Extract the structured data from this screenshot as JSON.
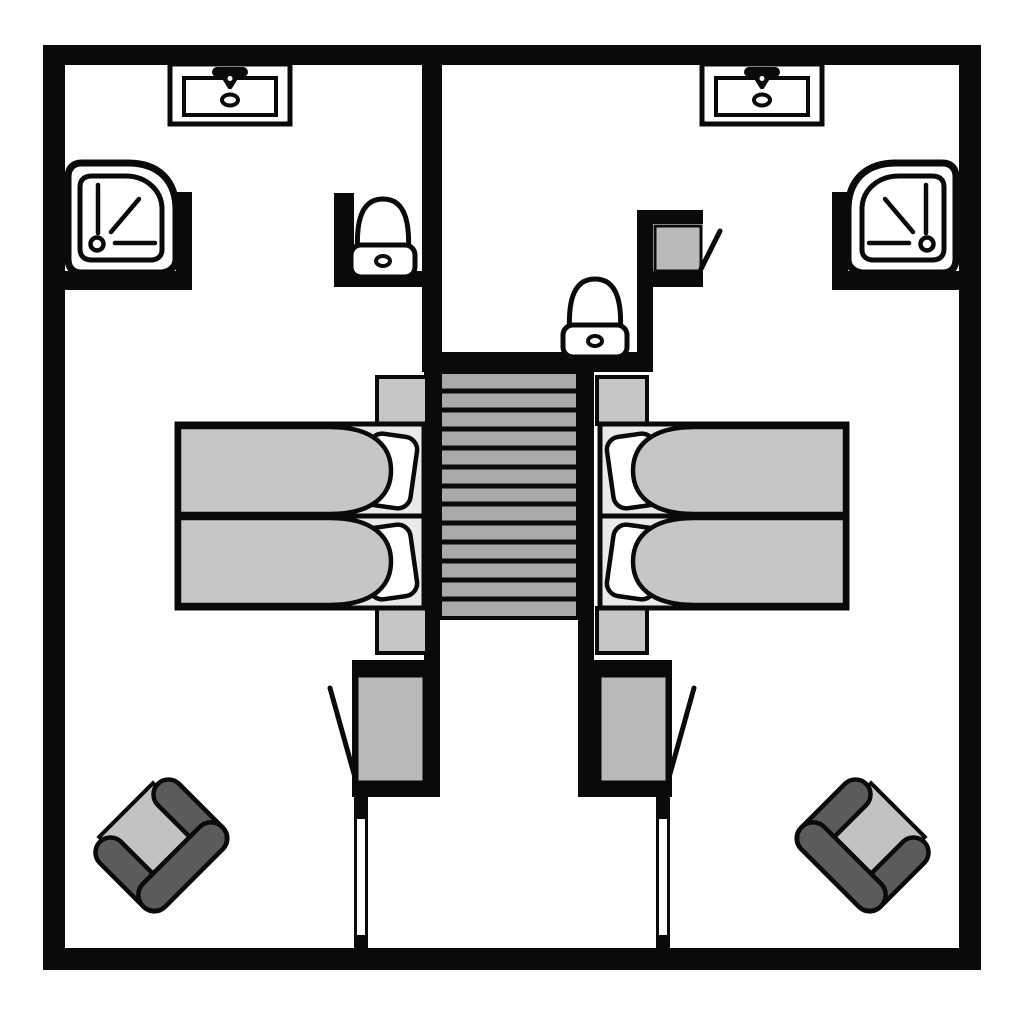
{
  "document": {
    "title": "Hotel floor plan - two mirrored twin rooms with central staircase",
    "type": "architectural-floor-plan",
    "visible_text": []
  },
  "palette": {
    "wall": "#0a0a0a",
    "paper": "#ffffff",
    "bed_base": "#eaeaea",
    "textile": "#c6c6c6",
    "cabinet": "#b9b9b9",
    "tread": "#a9a9a9",
    "chair_frame": "#5b5b5b",
    "chair_seat": "#c2c2c2"
  },
  "plan": {
    "staircase": {
      "treads": 13,
      "position": "center"
    },
    "units": [
      {
        "side": "left",
        "fixtures": [
          "washbasin-vanity",
          "shower",
          "wc-toilet",
          "twin-beds",
          "nightstand-top",
          "nightstand-bottom",
          "wardrobe",
          "entry-door",
          "armchair"
        ]
      },
      {
        "side": "right",
        "fixtures": [
          "washbasin-vanity",
          "shower",
          "wc-toilet",
          "closet",
          "twin-beds",
          "nightstand-top",
          "nightstand-bottom",
          "wardrobe",
          "entry-door",
          "armchair"
        ]
      }
    ]
  }
}
